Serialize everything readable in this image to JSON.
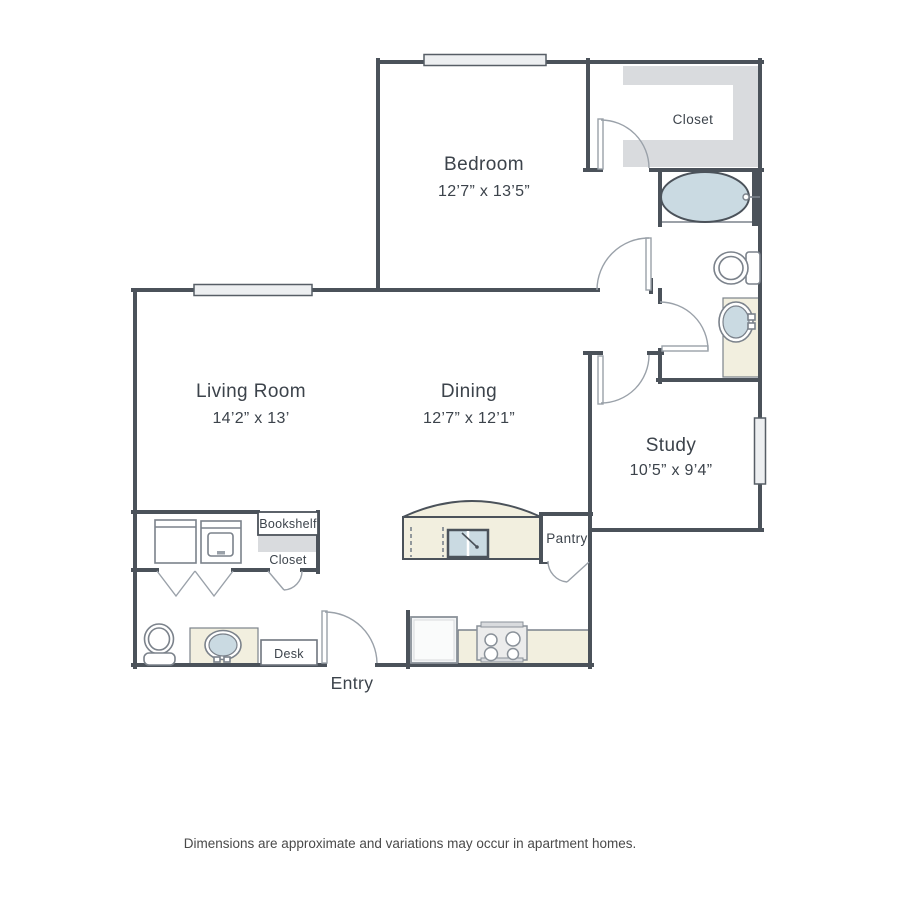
{
  "floorplan": {
    "rooms": {
      "bedroom": {
        "name": "Bedroom",
        "dims": "12’7” x 13’5”"
      },
      "living_room": {
        "name": "Living Room",
        "dims": "14’2” x 13’"
      },
      "dining": {
        "name": "Dining",
        "dims": "12’7” x 12’1”"
      },
      "study": {
        "name": "Study",
        "dims": "10’5” x 9’4”"
      }
    },
    "labels": {
      "walk_in_closet": "Closet",
      "bookshelf": "Bookshelf",
      "hall_closet": "Closet",
      "pantry": "Pantry",
      "desk": "Desk",
      "entry": "Entry"
    },
    "disclaimer": "Dimensions are approximate and variations may occur in apartment homes.",
    "colors": {
      "wall": "#4b525a",
      "counter_cream": "#f2efdf",
      "fixture_blue": "#cadae2",
      "shelf_gray": "#d9dbde",
      "text": "#3c434b"
    }
  }
}
